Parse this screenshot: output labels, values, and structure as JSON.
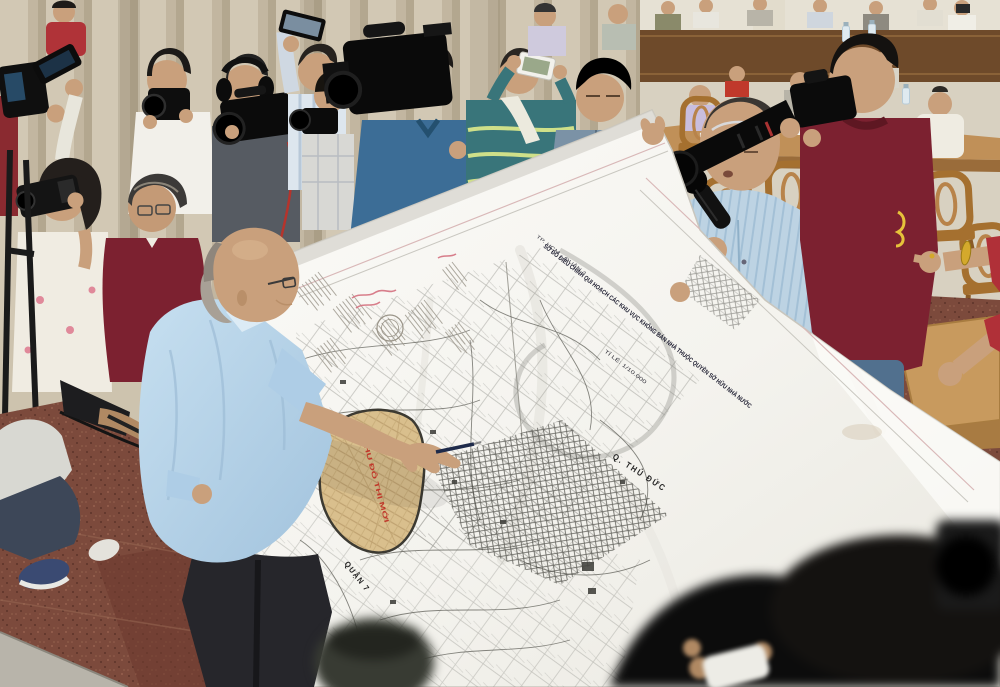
{
  "scene": {
    "caption": "Officials hold up a large white urban-planning map of District 2 (Thu Thiem, Ho Chi Minh City) before a crowd of journalists with cameras in a meeting hall"
  },
  "map": {
    "header_small": "TP. HCM - QUẬN 2",
    "title": "SƠ ĐỒ ĐIỀU CHỈNH QUI HOẠCH CÁC KHU VỰC KHÔNG BÁN NHÀ THUỘC QUYỀN SỞ HỮU NHÀ NƯỚC",
    "scale_note": "TỈ LỆ: 1/10.000",
    "labels": {
      "district_thu_duc": "Q. THỦ ĐỨC",
      "district_7": "QUẬN 7",
      "district_4": "QUẬN 4",
      "zone_red_note": "KHU ĐÔ THỊ MỚI"
    }
  },
  "palette": {
    "curtain": "#cdc3ae",
    "wall": "#d8d1c1",
    "wood_rail": "#6e4a2a",
    "chair_wood": "#a5702f",
    "floor_tile": "#7c4a3c",
    "map_paper": "#f6f5f0",
    "official_shirt": "#b5d2e8",
    "maroon_shirt": "#7c2130",
    "mic_man_shirt": "#bdd3e3",
    "blue_polo": "#3c6d96",
    "teal_hoodie": "#39757a",
    "skin": "#c9a07c"
  }
}
